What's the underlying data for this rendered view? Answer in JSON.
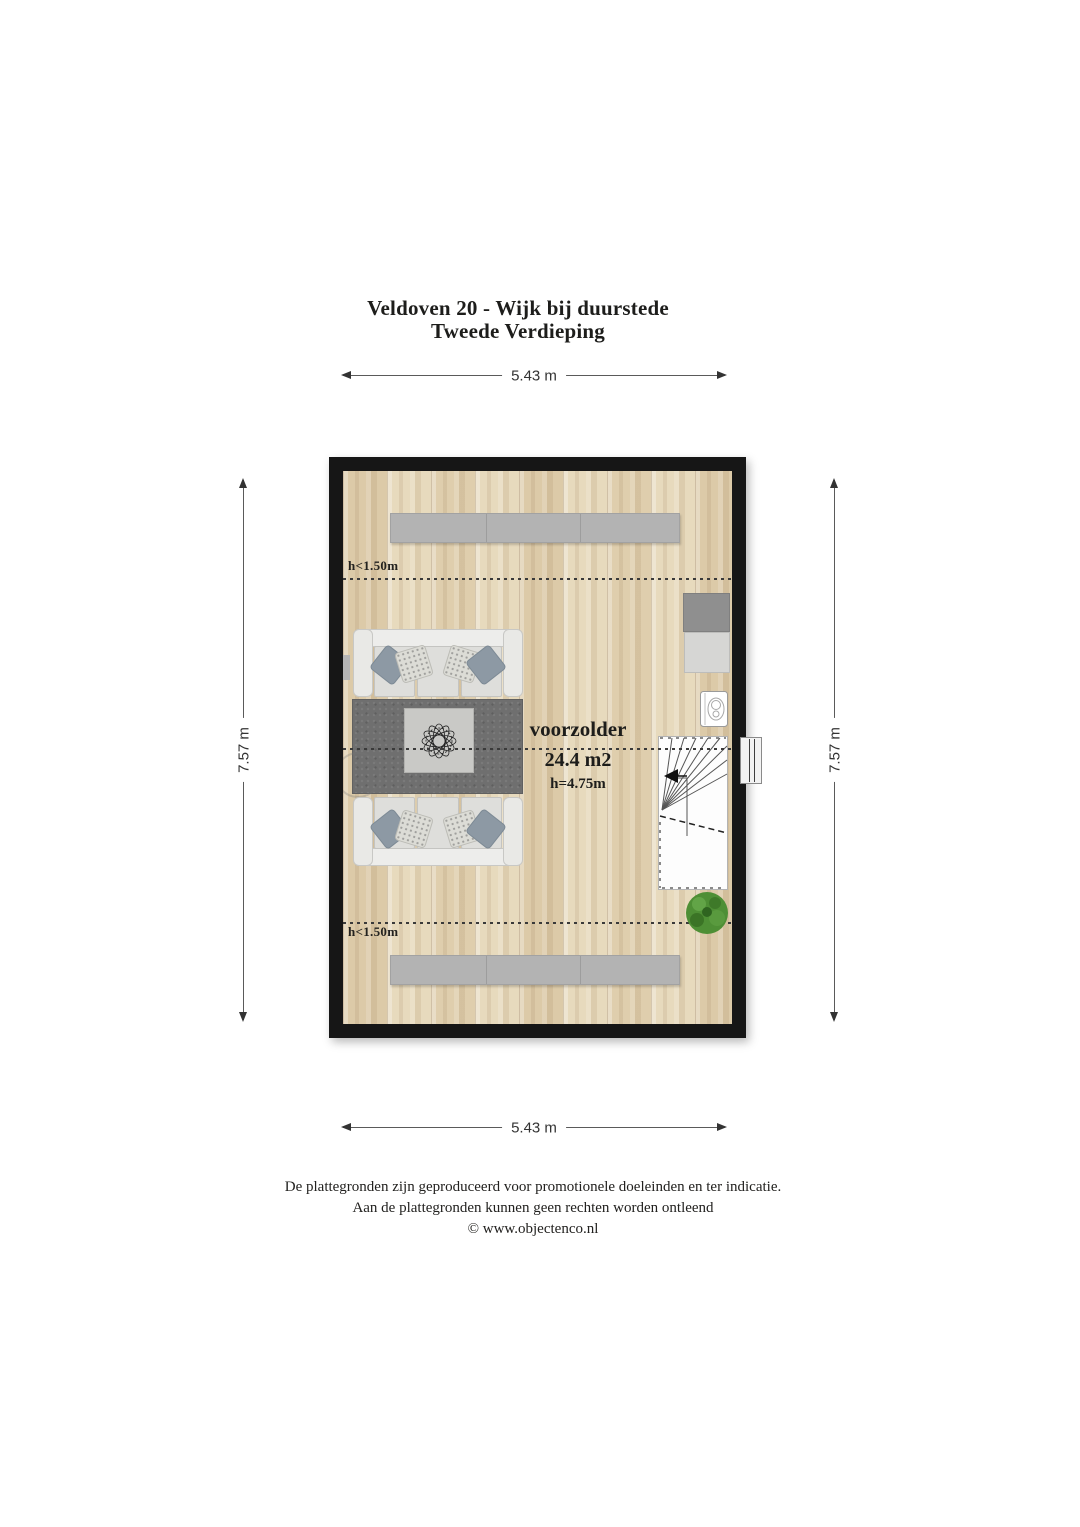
{
  "title": {
    "line1": "Veldoven 20 - Wijk bij duurstede",
    "line2": "Tweede Verdieping"
  },
  "dimensions": {
    "top": "5.43 m",
    "bottom": "5.43 m",
    "left": "7.57 m",
    "right": "7.57 m"
  },
  "room": {
    "name": "voorzolder",
    "area": "24.4 m2",
    "height": "h=4.75m"
  },
  "markers": {
    "top": "h<1.50m",
    "bottom": "h<1.50m"
  },
  "footer": {
    "line1": "De plattegronden zijn geproduceerd voor promotionele doeleinden en ter indicatie.",
    "line2": "Aan de plattegronden kunnen geen rechten worden ontleend",
    "line3": "© www.objectenco.nl"
  },
  "icons": {
    "staircase": "winder-stairs-with-direction-arrow",
    "boiler": "wall-boiler-unit",
    "plant": "potted-plant",
    "ornament": "wire-flower-centerpiece"
  },
  "colors": {
    "wall": "#161616",
    "floor": "#e4d6b9",
    "rug": "#6f6f6f",
    "cabinet": "#b3b3b3",
    "pillow": "#8d99a4",
    "plant": "#4e8f35",
    "dash": "#3a3a3a",
    "dimension": "#333333",
    "text": "#1d1d1b"
  }
}
